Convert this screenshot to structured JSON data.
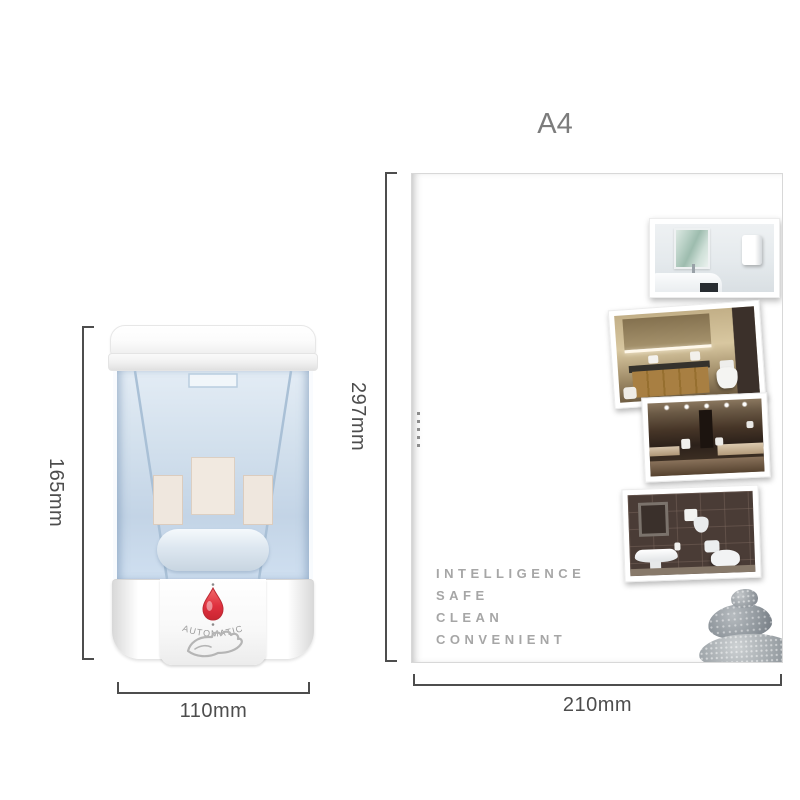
{
  "title": {
    "paper_size_label": "A4"
  },
  "dispenser": {
    "name": "automatic soap dispenser",
    "indicator_label": "AUTOMATIC",
    "dimensions": {
      "height": "165mm",
      "width": "110mm"
    }
  },
  "paper": {
    "dimensions": {
      "height": "297mm",
      "width": "210mm"
    },
    "features": [
      "INTELLIGENCE",
      "SAFE",
      "CLEAN",
      "CONVENIENT"
    ],
    "photos": [
      {
        "alt": "bright bathroom sink with wall-mounted dispenser"
      },
      {
        "alt": "wooden vanity bathroom with toilet"
      },
      {
        "alt": "dark marble public restroom"
      },
      {
        "alt": "dark tiled bathroom with sink and toilet"
      }
    ],
    "decor_alt": "stacked zen stones"
  },
  "colors": {
    "indicator_red": "#e0313f",
    "dimension_line": "#4d4d4d",
    "feature_text": "#a6a6a6",
    "title_gray": "#7c7c7c"
  }
}
